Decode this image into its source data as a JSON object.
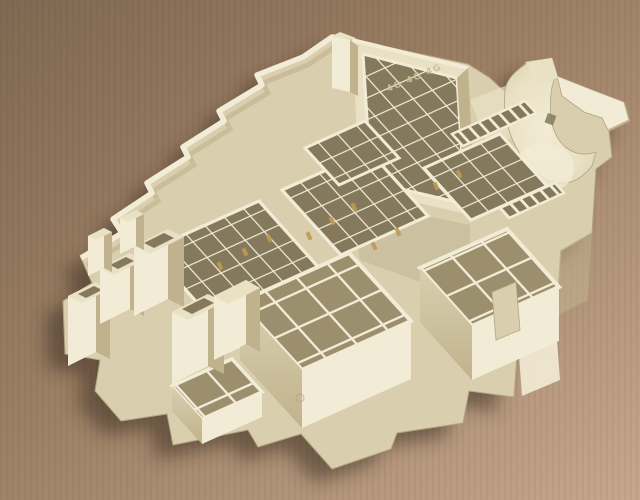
{
  "scene": {
    "subject": "Cream-beige injection-molded plastic automotive fuse and relay box housing viewed from above at an angle",
    "surface": "Brown kraft cardboard sheet, darker at top left, lighter pinkish tan at bottom right",
    "embossed_marking": "4G 4G 4G",
    "features": {
      "top_tray": "open rectangular tray with grid of relay compartments",
      "cable_scoop": "curved saddle-shaped wire outlet with retaining hook arm",
      "fuse_grids": "arrays of small square fuse compartments with brass terminal pins",
      "connector_towers": "rectangular connector shrouds protruding on the left side",
      "connector_blocks": "large smooth-walled connector sockets along the bottom",
      "shadow": "soft shadow cast to the lower left of the part"
    },
    "palette": {
      "bg_top": "#7c654e",
      "bg_mid": "#9b7d61",
      "bg_bottom": "#c8a88e",
      "plastic_light": "#f2ecd6",
      "plastic_top": "#e9e1c4",
      "plastic_mid": "#d9cfae",
      "plastic_shade": "#c0b28c",
      "plastic_dark": "#a89b76",
      "recess": "#84795c",
      "recess_big": "#9c8f6d",
      "pin_gold": "#bd9b50",
      "shadow": "#32281b",
      "outline": "#b2a480",
      "emboss": "#cabf9b"
    }
  }
}
